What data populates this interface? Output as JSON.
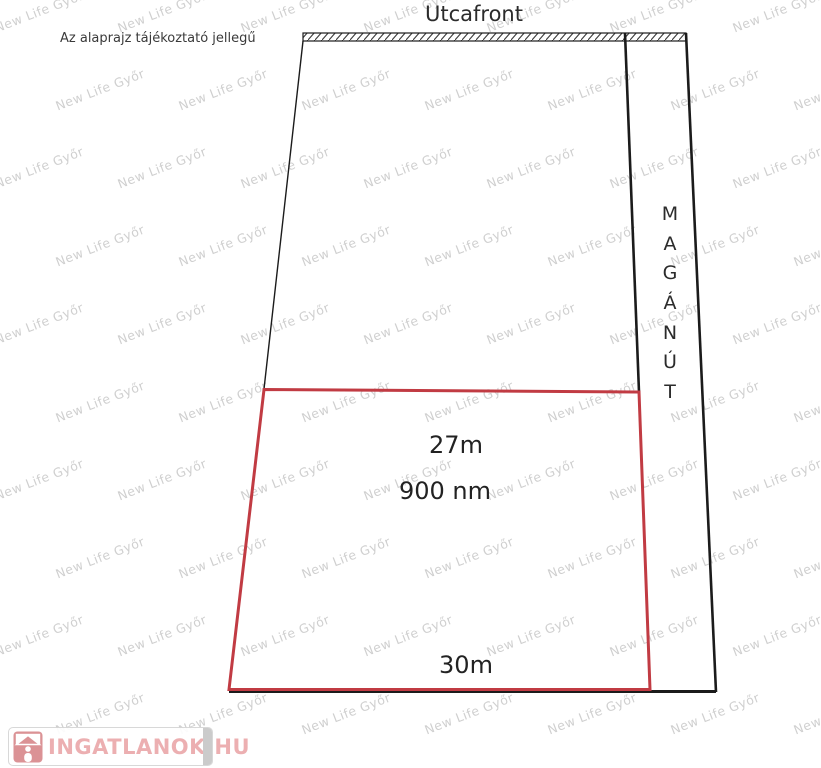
{
  "header": {
    "disclaimer": "Az alaprajz tájékoztató jellegű",
    "street_front_label": "Utcafront"
  },
  "plot": {
    "top_width_label": "27m",
    "area_label": "900 nm",
    "bottom_width_label": "30m",
    "outline_color": "#c13b43"
  },
  "private_road": {
    "label": "MAGÁNÚT",
    "letters": [
      "M",
      "A",
      "G",
      "Á",
      "N",
      "Ú",
      "T"
    ]
  },
  "watermark": {
    "text": "New Life Győr"
  },
  "logo": {
    "text": "INGATLANOK.HU"
  },
  "colors": {
    "line": "#1b1b1b",
    "plot_outline": "#c13b43",
    "logo_pink": "#d9898d",
    "logo_text": "#eba9ab",
    "watermark_gray": "#a8a8a8"
  }
}
